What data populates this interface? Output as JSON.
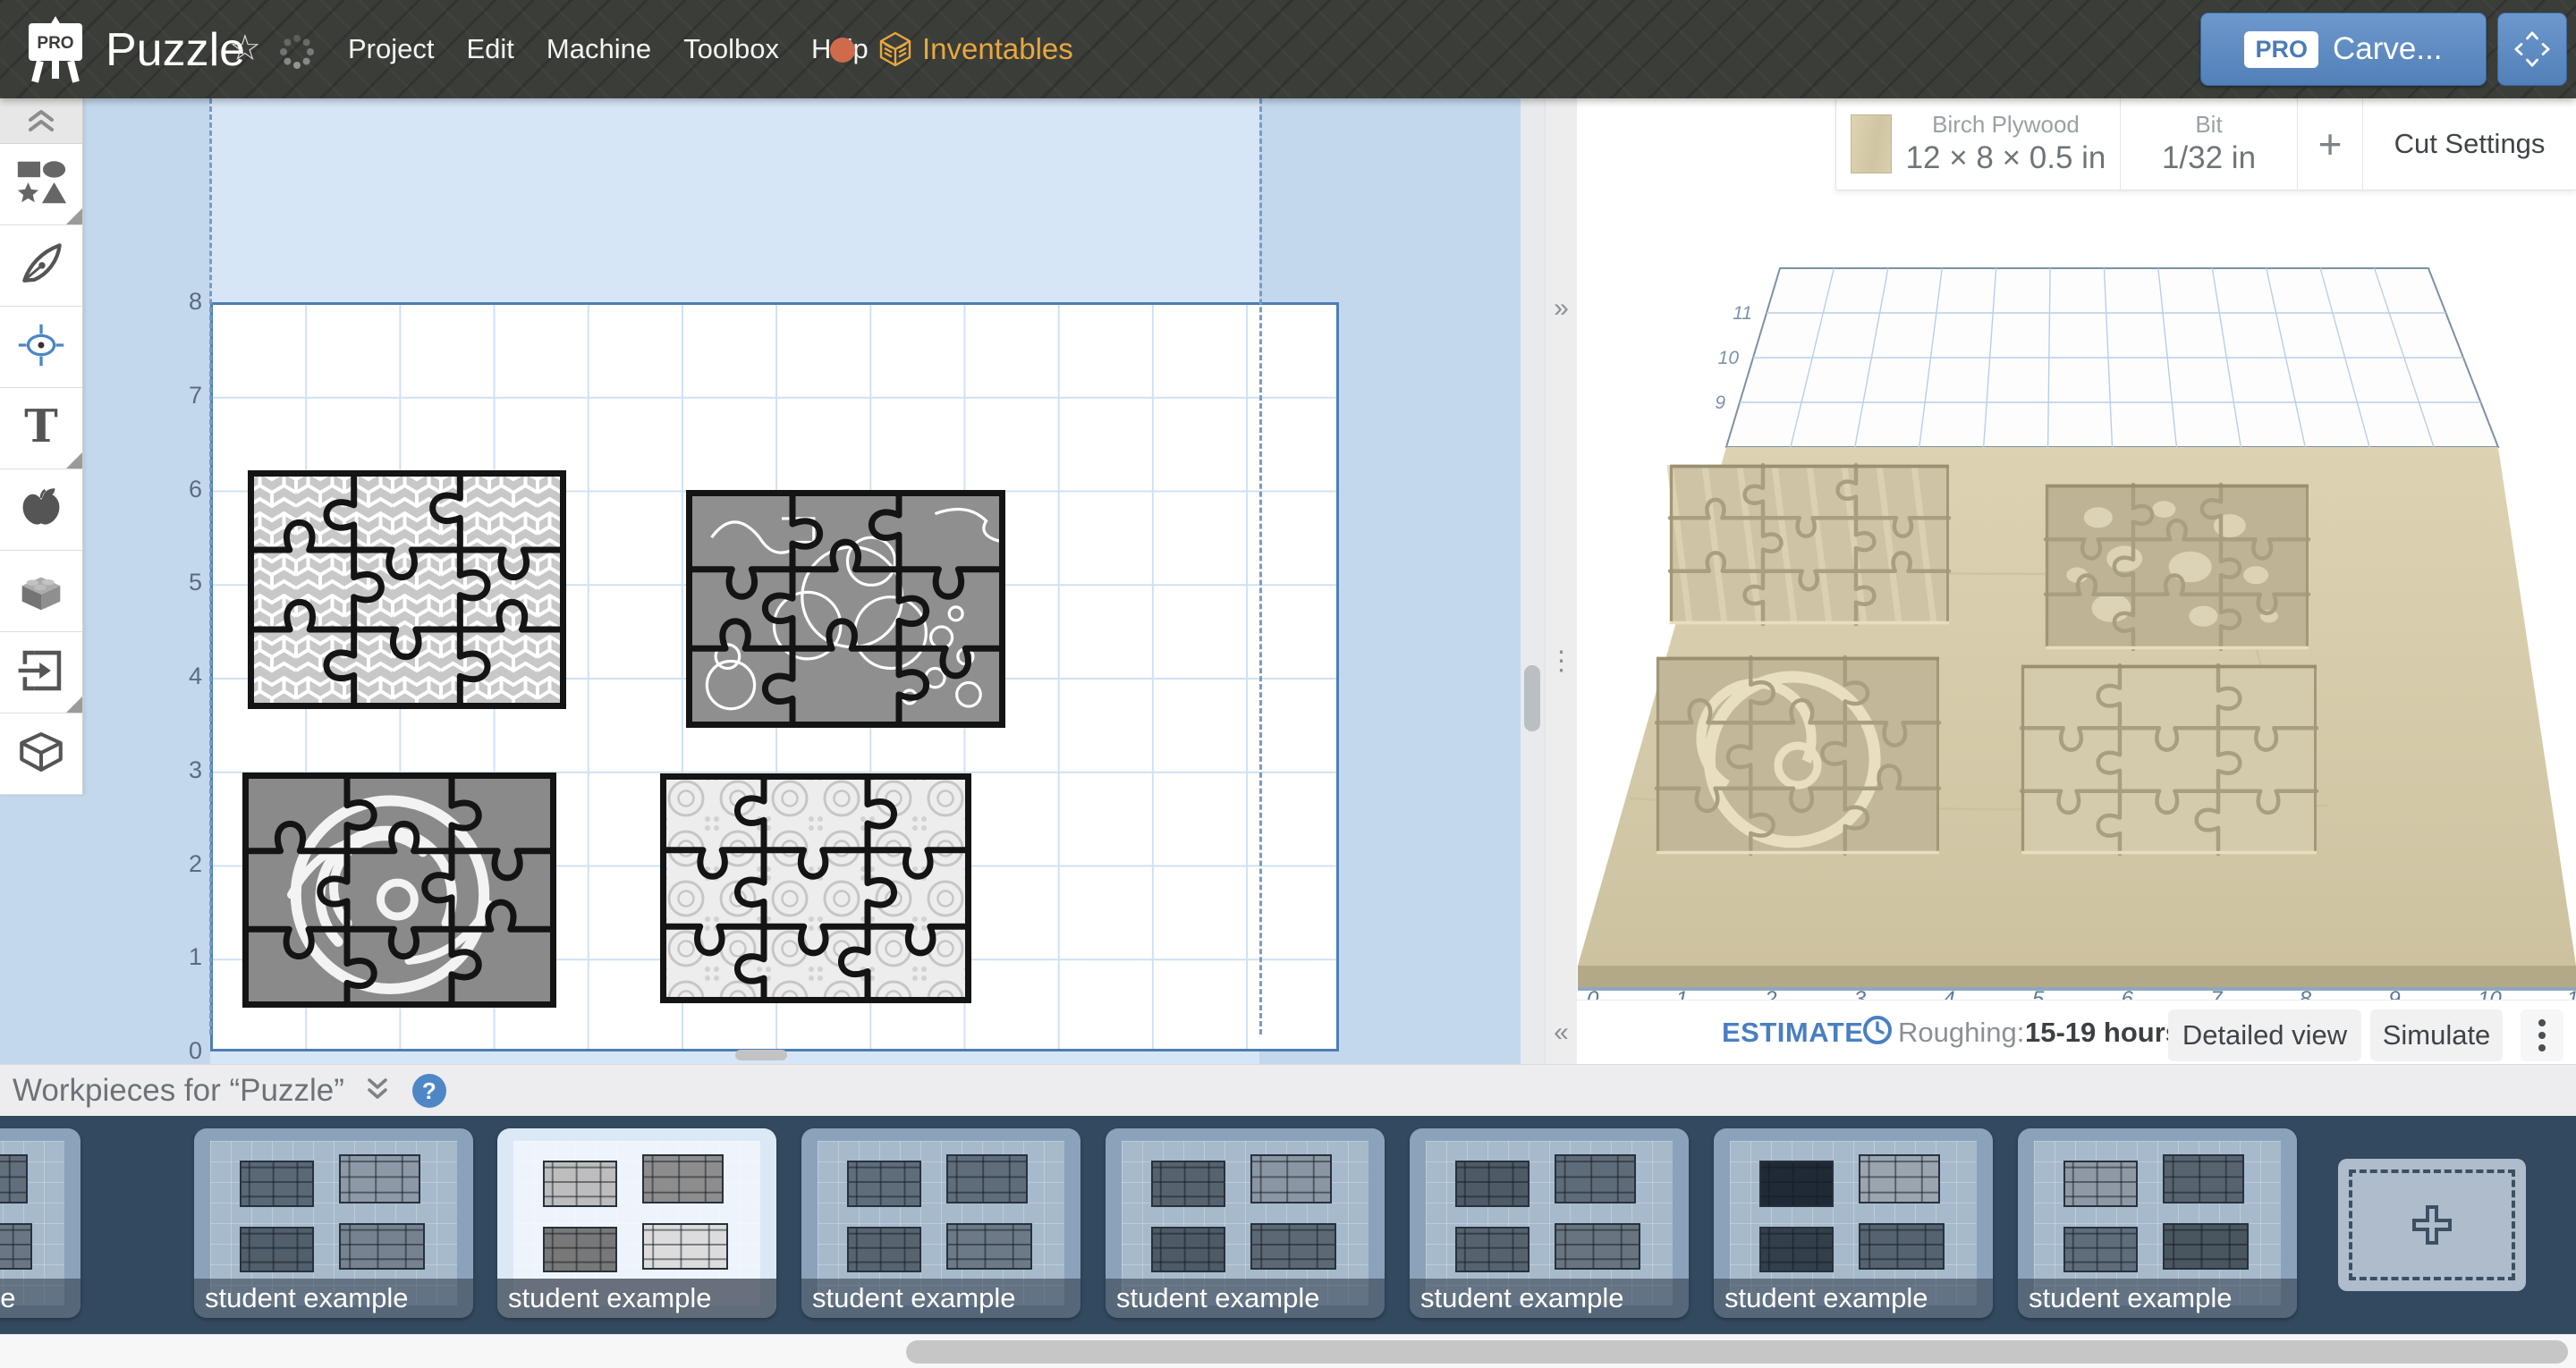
{
  "top_bar": {
    "logo_badge": "PRO",
    "title": "Puzzle",
    "star": "☆",
    "menu": [
      "Project",
      "Edit",
      "Machine",
      "Toolbox",
      "Help"
    ],
    "help_dot_color": "#cf6a4a",
    "brand": "Inventables",
    "brand_color": "#e9a83e",
    "carve": {
      "badge": "PRO",
      "label": "Carve..."
    }
  },
  "toolbar": {
    "items": [
      {
        "icon": "shapes-icon",
        "fold": true
      },
      {
        "icon": "pen-icon",
        "fold": false
      },
      {
        "icon": "crosshair-icon",
        "fold": false
      },
      {
        "icon": "text-icon",
        "fold": true
      },
      {
        "icon": "apple-icon",
        "fold": false
      },
      {
        "icon": "lego-icon",
        "fold": false
      },
      {
        "icon": "import-icon",
        "fold": true
      },
      {
        "icon": "cube-icon",
        "fold": false
      }
    ]
  },
  "canvas": {
    "x_ticks": [
      "0",
      "1",
      "2",
      "3",
      "4",
      "5",
      "6",
      "7",
      "8",
      "9",
      "10",
      "11",
      "12"
    ],
    "y_ticks": [
      "8",
      "7",
      "6",
      "5",
      "4",
      "3",
      "2",
      "1",
      "0"
    ],
    "unit_toggle": {
      "left": "inch",
      "right": "mm",
      "selected": "inch"
    },
    "zoom_out": "−",
    "zoom_in": "+",
    "work_area_right_in": 11.15,
    "puzzles": [
      {
        "name": "geometric-pattern-puzzle",
        "pattern": "geometric",
        "x": 0.4,
        "y": 3.66,
        "w": 3.38,
        "h": 2.55,
        "seed": 3
      },
      {
        "name": "doodle-animals-puzzle",
        "pattern": "doodles",
        "x": 5.06,
        "y": 3.46,
        "w": 3.39,
        "h": 2.54,
        "seed": 7
      },
      {
        "name": "swirl-medallion-puzzle",
        "pattern": "swirl",
        "x": 0.34,
        "y": 0.47,
        "w": 3.34,
        "h": 2.51,
        "seed": 11
      },
      {
        "name": "ornate-tiles-puzzle",
        "pattern": "ornate",
        "x": 4.78,
        "y": 0.52,
        "w": 3.31,
        "h": 2.45,
        "seed": 5
      }
    ]
  },
  "material_bar": {
    "material_name": "Birch Plywood",
    "material_dims": "12 × 8 × 0.5 in",
    "bit_label": "Bit",
    "bit_value": "1/32 in",
    "add_label": "+",
    "cut_settings_label": "Cut Settings"
  },
  "preview3d": {
    "front_ticks": [
      "0",
      "1",
      "2",
      "3",
      "4",
      "5",
      "6",
      "7",
      "8",
      "9",
      "10",
      "11"
    ],
    "depth_ticks": [
      "11",
      "10",
      "9"
    ],
    "wood_color": "#d5cbaa"
  },
  "estimate": {
    "label": "ESTIMATE",
    "stage_label": "Roughing:",
    "time": "15-19 hours",
    "detailed_label": "Detailed view",
    "simulate_label": "Simulate"
  },
  "workpieces": {
    "header": "Workpieces for “Puzzle”",
    "selected_index": 2,
    "cards": [
      {
        "label": "student example",
        "tones": [
          "#55626f",
          "#616e7c",
          "#4c5865",
          "#6a7684"
        ]
      },
      {
        "label": "student example",
        "tones": [
          "#5a6876",
          "#8d99a6",
          "#515e6b",
          "#76828f"
        ]
      },
      {
        "label": "student example",
        "tones": [
          "#bdbdbd",
          "#8d8d8d",
          "#787878",
          "#dcdcdc"
        ]
      },
      {
        "label": "student example",
        "tones": [
          "#5f6d7b",
          "#5f6d7b",
          "#57646f",
          "#6c7987"
        ]
      },
      {
        "label": "student example",
        "tones": [
          "#56636f",
          "#8a96a3",
          "#4e5a66",
          "#5c6975"
        ]
      },
      {
        "label": "student example",
        "tones": [
          "#4e5a66",
          "#5e6b78",
          "#56636f",
          "#68747f"
        ]
      },
      {
        "label": "student example",
        "tones": [
          "#1f2a36",
          "#9aa5b0",
          "#333f4b",
          "#55626f"
        ]
      },
      {
        "label": "student example",
        "tones": [
          "#8e99a5",
          "#57646f",
          "#5f6d7b",
          "#49555f"
        ]
      }
    ]
  }
}
